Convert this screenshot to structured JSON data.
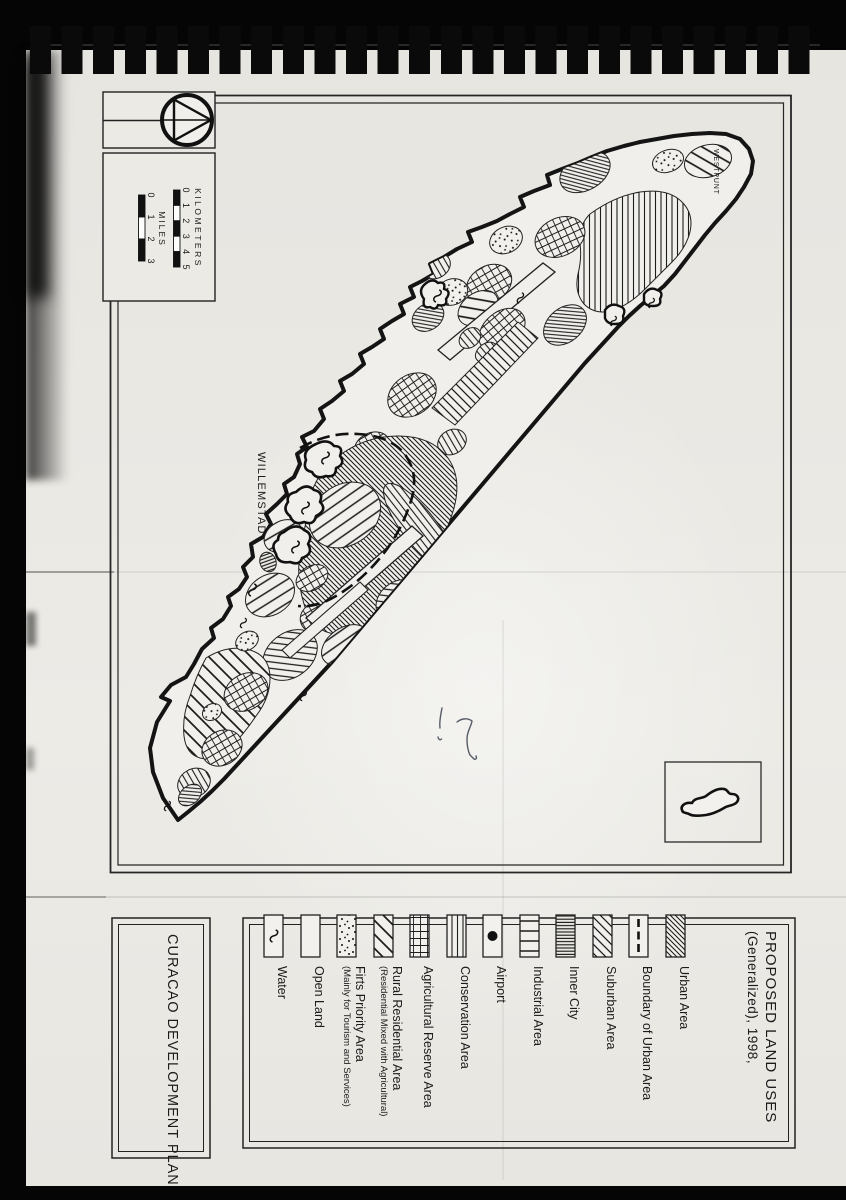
{
  "page": {
    "plan_box_label": "CURACAO DEVELOPMENT PLAN"
  },
  "map": {
    "labels": {
      "willemstad": "WILLEMSTAD",
      "westpunt": "WESTPUNT"
    },
    "scale": {
      "kilometers_label": "KILOMETERS",
      "km_ticks": [
        "0",
        "1",
        "2",
        "3",
        "4",
        "5"
      ],
      "miles_label": "MILES",
      "mile_ticks": [
        "0",
        "1",
        "2",
        "3"
      ]
    }
  },
  "legend": {
    "title_line1": "PROPOSED LAND USES",
    "title_line2": "(Generalized), 1998,",
    "items": [
      {
        "label": "Water",
        "pattern": "water-squiggle"
      },
      {
        "label": "Open Land",
        "pattern": "blank"
      },
      {
        "label": "Firts Priority Area",
        "sublabel": "(Mainly for Tourism and Services)",
        "pattern": "stipple-dots"
      },
      {
        "label": "Rural Residential Area",
        "sublabel": "(Residential Mixed with Agricultural)",
        "pattern": "wide-diagonal-stripes"
      },
      {
        "label": "Agricultural Reserve Area",
        "pattern": "grid-crosshatch"
      },
      {
        "label": "Conservation Area",
        "pattern": "vertical-lines"
      },
      {
        "label": "Airport",
        "pattern": "black-dot"
      },
      {
        "label": "Industrial Area",
        "pattern": "horizontal-bars"
      },
      {
        "label": "Inner City",
        "pattern": "dense-horizontal-lines"
      },
      {
        "label": "Suburban Area",
        "pattern": "medium-diagonal-stripes"
      },
      {
        "label": "Boundary of Urban Area",
        "pattern": "heavy-dashed-line"
      },
      {
        "label": "Urban Area",
        "pattern": "fine-diagonal-hatch"
      }
    ]
  },
  "colors": {
    "paper": "#eae8e3",
    "ink": "#1a1a1a"
  }
}
